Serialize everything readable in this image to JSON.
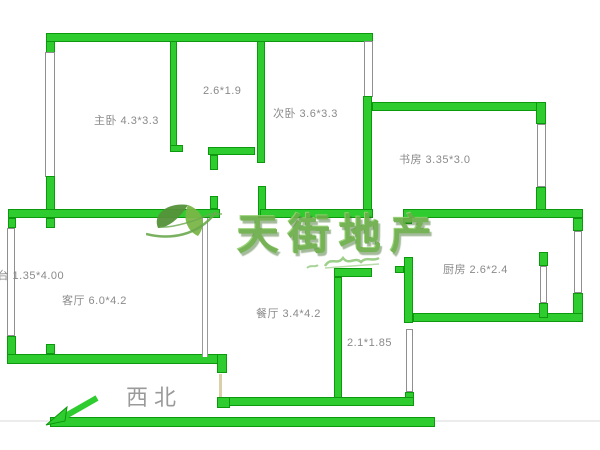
{
  "floorplan": {
    "rooms": [
      {
        "id": "master-bedroom",
        "label": "主卧 4.3*3.3"
      },
      {
        "id": "closet",
        "label": "2.6*1.9"
      },
      {
        "id": "second-bedroom",
        "label": "次卧 3.6*3.3"
      },
      {
        "id": "study",
        "label": "书房 3.35*3.0"
      },
      {
        "id": "balcony",
        "label": "阳台 1.35*4.00"
      },
      {
        "id": "living-room",
        "label": "客厅 6.0*4.2"
      },
      {
        "id": "dining-room",
        "label": "餐厅 3.4*4.2"
      },
      {
        "id": "bathroom",
        "label": "2.1*1.85"
      },
      {
        "id": "kitchen",
        "label": "厨房 2.6*2.4"
      }
    ],
    "compass": {
      "direction_label": "西北"
    },
    "watermark": {
      "brand_text": "天街地产",
      "logo": "leaf-logo"
    },
    "colors": {
      "wall_green": "#2fcc2f",
      "wall_outline": "#0d990d",
      "label_gray": "#8a8a8a",
      "watermark_green": "#6cae4a",
      "compass_gray": "#9a9a9a"
    }
  }
}
